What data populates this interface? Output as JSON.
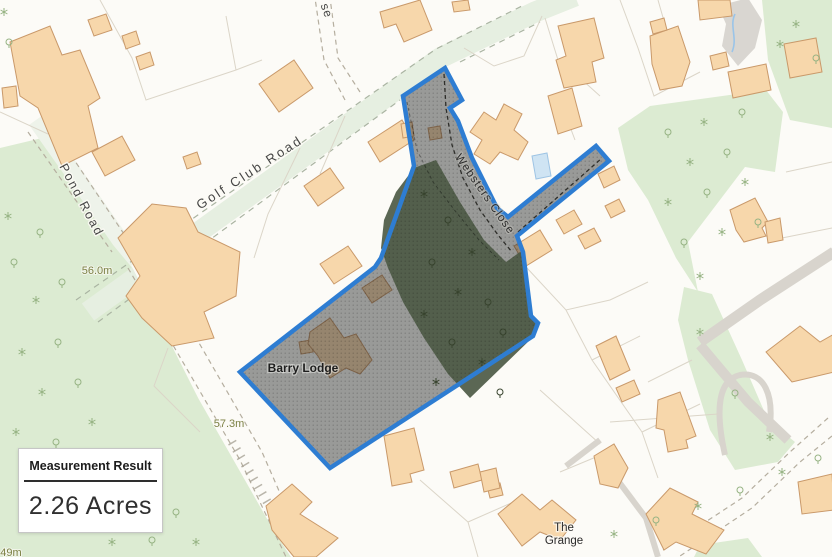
{
  "measurement_panel": {
    "title": "Measurement Result",
    "value": "2.26 Acres"
  },
  "map_labels": {
    "roads": {
      "golf_club_road": "Golf Club Road",
      "pond_road": "Pond Road",
      "websters_close": "Websters Close",
      "partial_close": "se"
    },
    "places": {
      "barry_lodge": "Barry Lodge",
      "the_grange_line1": "The",
      "the_grange_line2": "Grange"
    },
    "spot_heights": {
      "h1": "56.0m",
      "h2": "57.3m",
      "h3": "49m"
    }
  },
  "colors": {
    "map_bg": "#fcfbf7",
    "woodland": "#dcebd2",
    "woodland_dark": "#4d5a45",
    "road_tint": "#e6efe1",
    "road_tint2": "#eef3ea",
    "building_fill": "#f7d7ab",
    "building_stroke": "#c9996a",
    "parcel": "#dbd5c8",
    "accent_blue": "#2e7dd2",
    "overlay": "rgba(28,29,31,0.44)",
    "water": "#cfe4f3",
    "water_stroke": "#9ec4e4",
    "spot_text": "#7c8144",
    "label_text": "#454545",
    "path_gray": "#d8d4cd"
  }
}
